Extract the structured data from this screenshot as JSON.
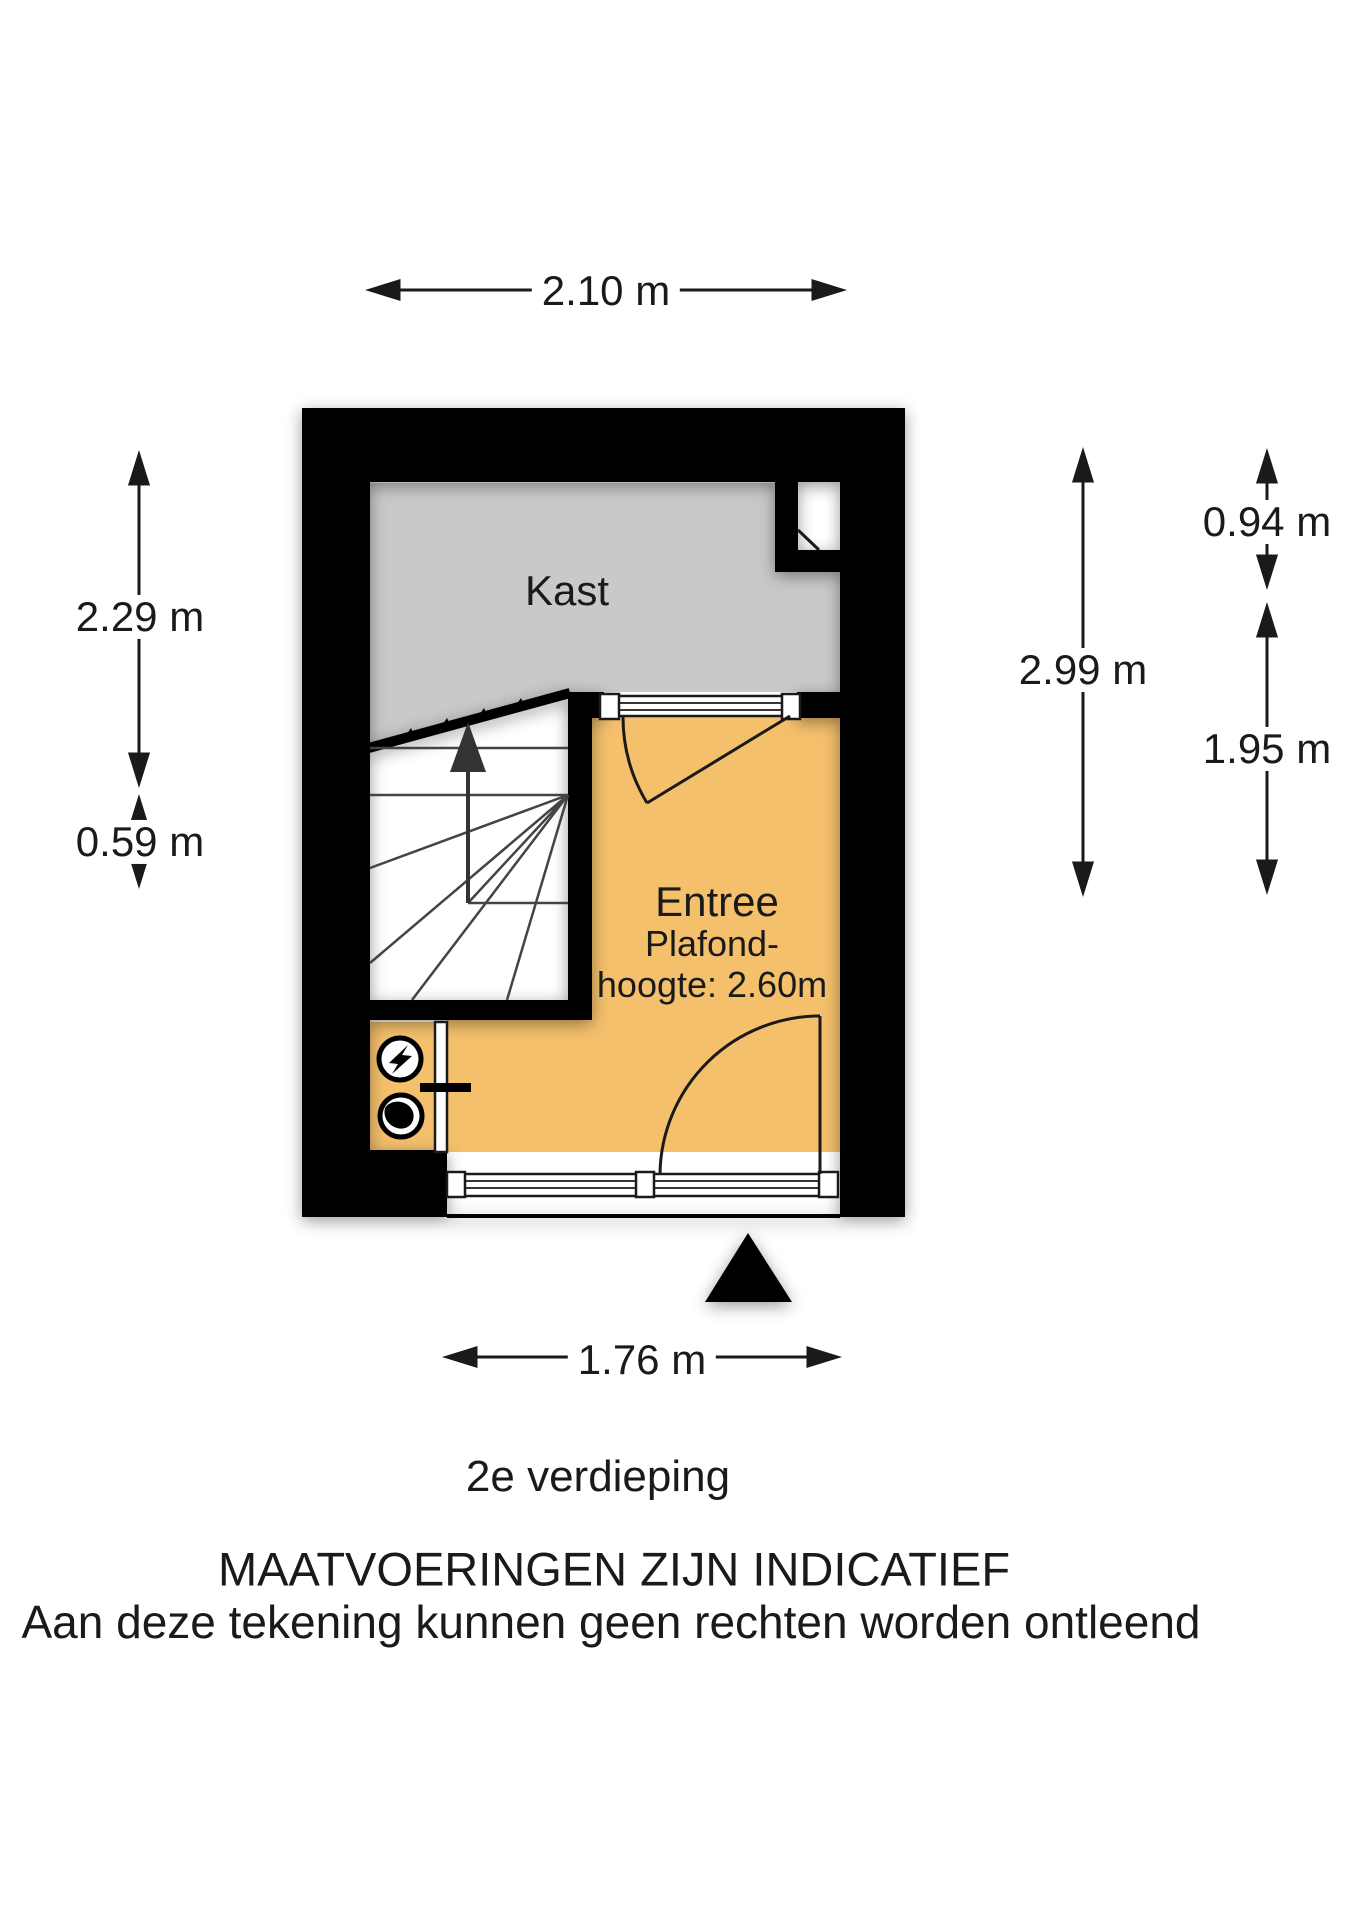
{
  "title": "2e verdieping floor plan",
  "floor_label": "2e verdieping",
  "disclaimer": {
    "line1": "MAATVOERINGEN ZIJN INDICATIEF",
    "line2": "Aan deze tekening kunnen geen rechten worden ontleend"
  },
  "rooms": {
    "kast": {
      "label": "Kast"
    },
    "entree": {
      "label": "Entree",
      "ceiling_line1": "Plafond-",
      "ceiling_line2": "hoogte: 2.60m",
      "ceiling_height": "2.60m"
    }
  },
  "dimensions": {
    "top_width": "2.10 m",
    "left_upper": "2.29 m",
    "left_lower": "0.59 m",
    "right_full": "2.99 m",
    "right_upper": "0.94 m",
    "right_lower": "1.95 m",
    "bottom_width": "1.76 m"
  },
  "icons": {
    "electric_meter": "lightning-bolt-in-circle",
    "water_meter": "drop-in-circle",
    "stairs_direction": "up-arrow",
    "entrance_marker": "solid-triangle",
    "dimension_arrows": "double-headed-arrows"
  },
  "colors": {
    "wall": "#000000",
    "kast_floor": "#c9c9c9",
    "entree_floor": "#f4c06c",
    "stair_line": "#444444",
    "background": "#ffffff"
  }
}
